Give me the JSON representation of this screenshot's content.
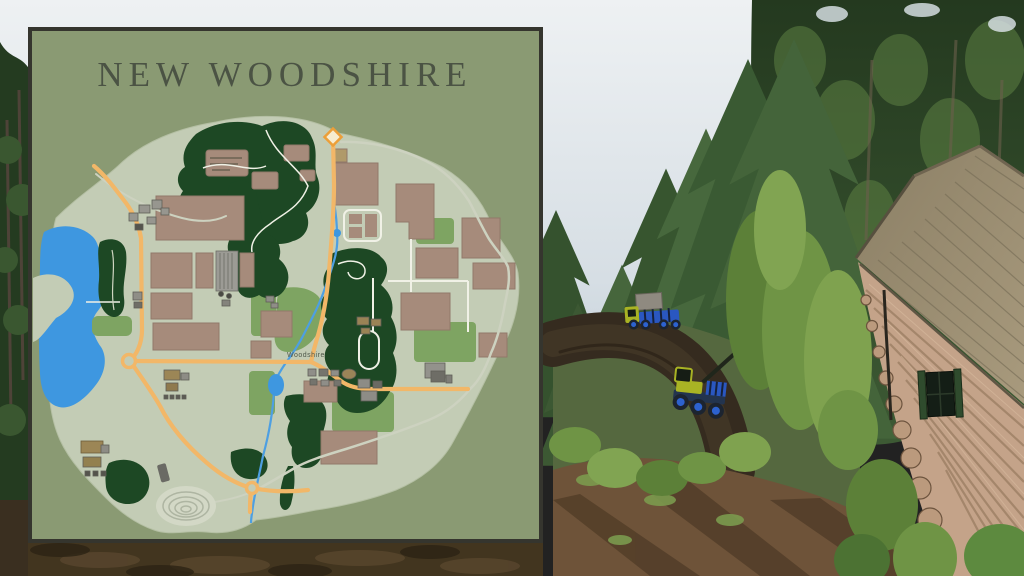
{
  "map_panel": {
    "title": "NEW WOODSHIRE",
    "town_label": "Woodshire",
    "colors": {
      "background": "#8a9a73",
      "border": "#35352e",
      "land": "#c3ccb5",
      "water": "#3e97e0",
      "forest": "#1d4824",
      "grass": "#7ea462",
      "field": "#a68b7b",
      "road_main": "#f2b768",
      "road_minor": "#cdd2c0",
      "marker": "#ec9f39",
      "title_text": "#4b5344"
    }
  },
  "scene": {
    "sky_color": "#e9edf0",
    "forest_dark": "#2c4427",
    "forest_mid": "#47683d",
    "ground_color": "#6e5339",
    "road_color": "#352b1f",
    "machines": [
      {
        "name": "forestry-harvester",
        "body_color": "#a9b324",
        "wheel_color": "#2d62cf"
      },
      {
        "name": "forestry-forwarder",
        "body_color": "#a9b324",
        "wheel_color": "#2a57c0"
      }
    ],
    "cabin": {
      "roof_color": "#998c6e",
      "wall_color": "#c4a389",
      "shutter_color": "#2f4b2d"
    }
  }
}
